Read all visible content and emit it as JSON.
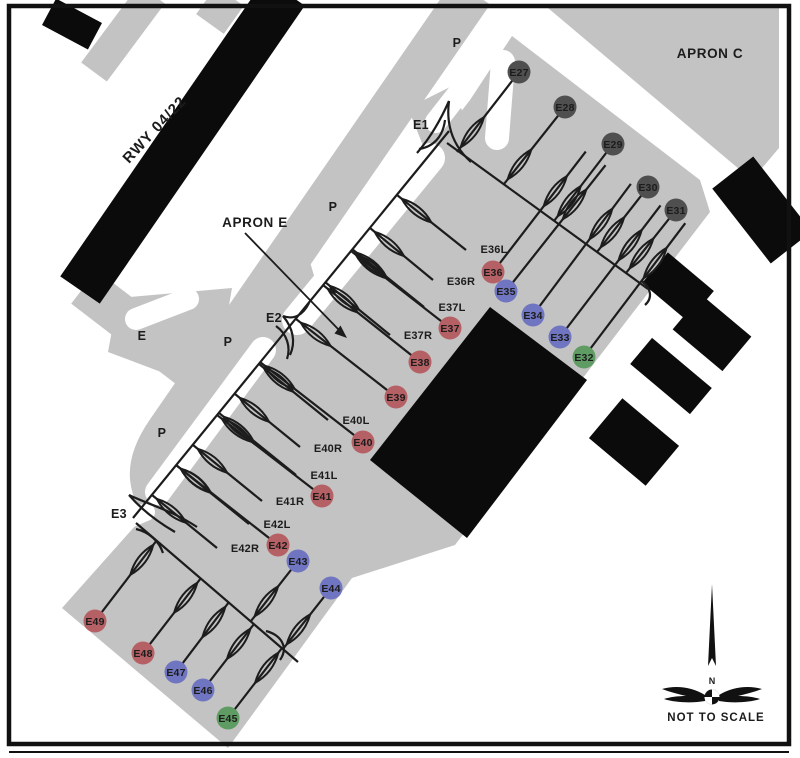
{
  "labels": {
    "apron_c": "APRON C",
    "apron_e": "APRON E",
    "runway": "RWY 04/22",
    "not_to_scale": "NOT TO SCALE",
    "north": "N"
  },
  "colors": {
    "paving": "#c3c3c3",
    "building": "#0b0b0b",
    "line": "#1c1c1c",
    "stand_red": "#b56064",
    "stand_blue": "#6f75c0",
    "stand_green": "#5f9c63",
    "stand_dark": "#4f4f4f",
    "stand_text": "#101010"
  },
  "taxiway_labels": [
    {
      "text": "P",
      "x": 457,
      "y": 47
    },
    {
      "text": "P",
      "x": 333,
      "y": 211
    },
    {
      "text": "P",
      "x": 228,
      "y": 346
    },
    {
      "text": "P",
      "x": 162,
      "y": 437
    },
    {
      "text": "E",
      "x": 142,
      "y": 340
    },
    {
      "text": "E1",
      "x": 421,
      "y": 129
    },
    {
      "text": "E2",
      "x": 274,
      "y": 322
    },
    {
      "text": "E3",
      "x": 119,
      "y": 518
    }
  ],
  "stands": [
    {
      "id": "E27",
      "color": "dark",
      "cx": 519,
      "cy": 72,
      "jx": 457,
      "jy": 152,
      "ext": 0
    },
    {
      "id": "E28",
      "color": "dark",
      "cx": 565,
      "cy": 107,
      "jx": 504,
      "jy": 184,
      "ext": 0
    },
    {
      "id": "E29",
      "color": "dark",
      "cx": 613,
      "cy": 144,
      "jx": 554,
      "jy": 221,
      "ext": 0
    },
    {
      "id": "E30",
      "color": "dark",
      "cx": 648,
      "cy": 187,
      "jx": 597,
      "jy": 252,
      "ext": 0
    },
    {
      "id": "E31",
      "color": "dark",
      "cx": 676,
      "cy": 210,
      "jx": 626,
      "jy": 273,
      "ext": 0
    },
    {
      "id": "E36",
      "color": "red",
      "cx": 493,
      "cy": 272,
      "jx": 540,
      "jy": 211,
      "ext": 75
    },
    {
      "id": "E35",
      "color": "blue",
      "cx": 506,
      "cy": 291,
      "jx": 559,
      "jy": 224,
      "ext": 75
    },
    {
      "id": "E34",
      "color": "blue",
      "cx": 533,
      "cy": 315,
      "jx": 586,
      "jy": 244,
      "ext": 75
    },
    {
      "id": "E33",
      "color": "blue",
      "cx": 560,
      "cy": 337,
      "jx": 615,
      "jy": 265,
      "ext": 75
    },
    {
      "id": "E32",
      "color": "green",
      "cx": 584,
      "cy": 357,
      "jx": 640,
      "jy": 283,
      "ext": 75
    },
    {
      "id": "E37",
      "color": "red",
      "cx": 450,
      "cy": 328,
      "jx": 351,
      "jy": 251,
      "ext": 0
    },
    {
      "id": "E38",
      "color": "red",
      "cx": 420,
      "cy": 362,
      "jx": 323,
      "jy": 285,
      "ext": 0
    },
    {
      "id": "E39",
      "color": "red",
      "cx": 396,
      "cy": 397,
      "jx": 296,
      "jy": 319,
      "ext": 0
    },
    {
      "id": "E40",
      "color": "red",
      "cx": 363,
      "cy": 442,
      "jx": 260,
      "jy": 362,
      "ext": 0
    },
    {
      "id": "E41",
      "color": "red",
      "cx": 322,
      "cy": 496,
      "jx": 217,
      "jy": 415,
      "ext": 0
    },
    {
      "id": "E42",
      "color": "red",
      "cx": 278,
      "cy": 545,
      "jx": 176,
      "jy": 465,
      "ext": 0
    },
    {
      "id": "E43",
      "color": "blue",
      "cx": 298,
      "cy": 561,
      "jx": 251,
      "jy": 621,
      "ext": 0
    },
    {
      "id": "E44",
      "color": "blue",
      "cx": 331,
      "cy": 588,
      "jx": 283,
      "jy": 649,
      "ext": 0
    },
    {
      "id": "E45",
      "color": "green",
      "cx": 228,
      "cy": 718,
      "jx": 282,
      "jy": 648,
      "ext": 0
    },
    {
      "id": "E46",
      "color": "blue",
      "cx": 203,
      "cy": 690,
      "jx": 254,
      "jy": 624,
      "ext": 0
    },
    {
      "id": "E47",
      "color": "blue",
      "cx": 176,
      "cy": 672,
      "jx": 229,
      "jy": 602,
      "ext": 0
    },
    {
      "id": "E48",
      "color": "red",
      "cx": 143,
      "cy": 653,
      "jx": 201,
      "jy": 578,
      "ext": 0
    },
    {
      "id": "E49",
      "color": "red",
      "cx": 95,
      "cy": 621,
      "jx": 157,
      "jy": 540,
      "ext": 0
    }
  ],
  "stand_sublabels": [
    {
      "text": "E36L",
      "x": 494,
      "y": 249,
      "jx": 397,
      "jy": 195,
      "ex": 466,
      "ey": 250
    },
    {
      "text": "E36R",
      "x": 461,
      "y": 281,
      "jx": 370,
      "jy": 228,
      "ex": 433,
      "ey": 280
    },
    {
      "text": "E37L",
      "x": 452,
      "y": 307,
      "jx": 352,
      "jy": 249,
      "ex": 424,
      "ey": 307
    },
    {
      "text": "E37R",
      "x": 418,
      "y": 335,
      "jx": 325,
      "jy": 282,
      "ex": 390,
      "ey": 335
    },
    {
      "text": "E40L",
      "x": 356,
      "y": 420,
      "jx": 259,
      "jy": 364,
      "ex": 328,
      "ey": 420
    },
    {
      "text": "E40R",
      "x": 328,
      "y": 448,
      "jx": 235,
      "jy": 394,
      "ex": 300,
      "ey": 447
    },
    {
      "text": "E41L",
      "x": 324,
      "y": 475,
      "jx": 219,
      "jy": 413,
      "ex": 296,
      "ey": 475
    },
    {
      "text": "E41R",
      "x": 290,
      "y": 501,
      "jx": 193,
      "jy": 445,
      "ex": 262,
      "ey": 501
    },
    {
      "text": "E42L",
      "x": 277,
      "y": 524,
      "jx": 176,
      "jy": 465,
      "ex": 249,
      "ey": 524
    },
    {
      "text": "E42R",
      "x": 245,
      "y": 548,
      "jx": 152,
      "jy": 495,
      "ex": 217,
      "ey": 548
    }
  ]
}
